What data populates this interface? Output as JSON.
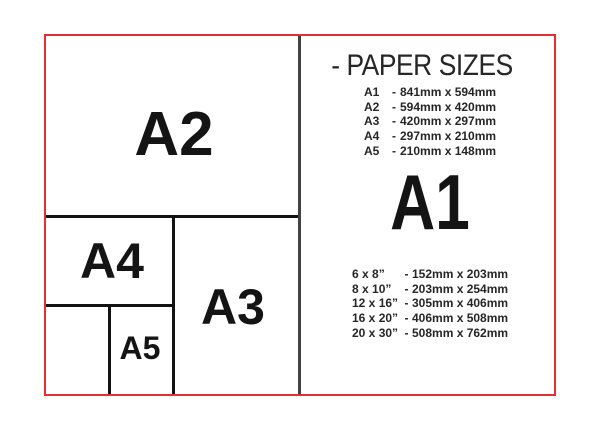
{
  "title": "- PAPER SIZES",
  "separator": "-",
  "featured": {
    "label": "A1"
  },
  "diagram": {
    "a2_label": "A2",
    "a3_label": "A3",
    "a4_label": "A4",
    "a5_label": "A5"
  },
  "a_sizes": [
    {
      "label": "A1",
      "value": "841mm x 594mm"
    },
    {
      "label": "A2",
      "value": "594mm x 420mm"
    },
    {
      "label": "A3",
      "value": "420mm x 297mm"
    },
    {
      "label": "A4",
      "value": "297mm x 210mm"
    },
    {
      "label": "A5",
      "value": "210mm x 148mm"
    }
  ],
  "inch_sizes": [
    {
      "label": "6 x 8”",
      "value": "152mm x 203mm"
    },
    {
      "label": "8 x 10”",
      "value": "203mm x 254mm"
    },
    {
      "label": "12 x 16”",
      "value": "305mm x 406mm"
    },
    {
      "label": "16 x 20”",
      "value": "406mm x 508mm"
    },
    {
      "label": "20 x 30”",
      "value": "508mm x 762mm"
    }
  ],
  "colors": {
    "border_red": "#e62d32",
    "divider_gray": "#424242",
    "line_black": "#121212",
    "text": "#262626"
  }
}
